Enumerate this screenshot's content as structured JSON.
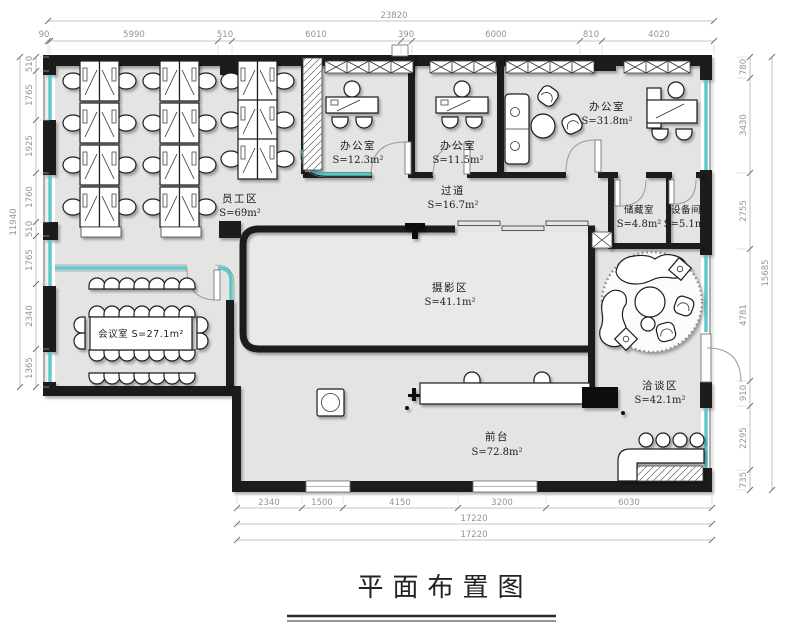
{
  "title": {
    "text": "平面布置图"
  },
  "rooms": {
    "staff": {
      "name": "员工区",
      "area": "S=69m²"
    },
    "office_a": {
      "name": "办公室",
      "area": "S=12.3m²"
    },
    "office_b": {
      "name": "办公室",
      "area": "S=11.5m²"
    },
    "office_c": {
      "name": "办公室",
      "area": "S=31.8m²"
    },
    "corridor": {
      "name": "过道",
      "area": "S=16.7m²"
    },
    "storage": {
      "name": "储藏室",
      "area": "S=4.8m²"
    },
    "equipment": {
      "name": "设备间",
      "area": "S=5.1m²"
    },
    "meeting": {
      "label": "会议室 S=27.1m²"
    },
    "photo": {
      "name": "摄影区",
      "area": "S=41.1m²"
    },
    "negotiation": {
      "name": "洽谈区",
      "area": "S=42.1m²"
    },
    "reception": {
      "name": "前台",
      "area": "S=72.8m²"
    }
  },
  "dimensions": {
    "top": {
      "total": "23820",
      "segments": [
        "90",
        "5990",
        "510",
        "6010",
        "390",
        "6000",
        "810",
        "4020"
      ]
    },
    "left": {
      "total": "11940",
      "segments": [
        "510",
        "1765",
        "1925",
        "1760",
        "510",
        "1765",
        "2340",
        "1365"
      ]
    },
    "right": {
      "total": "15685",
      "segments": [
        "780",
        "3430",
        "2755",
        "4781",
        "910",
        "2295",
        "735"
      ]
    },
    "bottom": {
      "segments": [
        "2340",
        "1500",
        "4150",
        "3200",
        "6030"
      ],
      "totals": [
        "17220",
        "17220"
      ]
    }
  },
  "colors": {
    "wall": "#1b1b1b",
    "floor": "#e4e4e3",
    "glass": "#5fc8ca",
    "dimline": "#b3b3b3",
    "dimtext": "#949494"
  }
}
